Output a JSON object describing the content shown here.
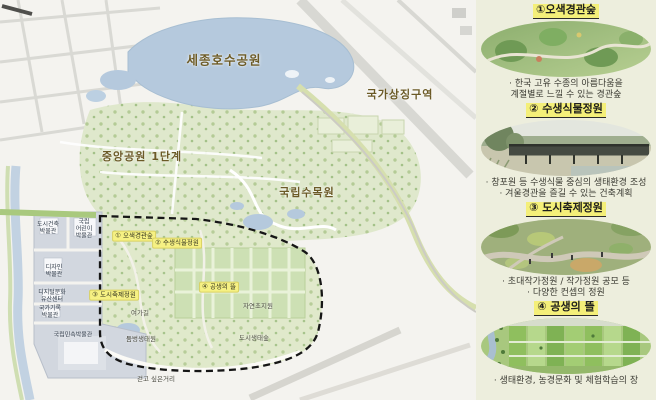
{
  "map": {
    "region_labels": {
      "lake_park": "세종호수공원",
      "national_symbol_zone": "국가상징구역",
      "central_park_phase1": "중앙공원 1단계",
      "national_arboretum": "국립수목원"
    },
    "numbered_labels": {
      "n1": "① 오색경관숲",
      "n2": "② 수생식물정원",
      "n3": "③ 도시축제정원",
      "n4": "④ 공생의 뜰"
    },
    "museum_labels": {
      "urban_architecture": "도시건축\n박물관",
      "children": "국립\n어린이\n박물관",
      "design": "디자인\n박물관",
      "digital_heritage": "디지털문화\n유산센터",
      "archives": "국가기록\n박물관",
      "folk": "국립민속박물관"
    },
    "feature_labels": {
      "leisure_trail": "여가길",
      "pond_eco_garden": "둠벙생태원",
      "natural_grassland": "자연초지원",
      "urban_eco_forest": "도시생태숲",
      "walking_street": "걷고 싶은거리"
    }
  },
  "sidebar": {
    "items": [
      {
        "title": "①오색경관숲",
        "captions": [
          "· 한국 고유 수종의 아름다움을",
          "계절별로 느낄 수 있는 경관숲"
        ]
      },
      {
        "title": "② 수생식물정원",
        "captions": [
          "· 창포원 등 수생식물 중심의 생태환경 조성",
          "· 겨울경관을 즐길 수 있는 건축계획"
        ]
      },
      {
        "title": "③ 도시축제정원",
        "captions": [
          "· 초대작가정원 / 작가정원 공모 등",
          "· 다양한 컨셉의 정원"
        ]
      },
      {
        "title": "④ 공생의 뜰",
        "captions": [
          "· 생태환경, 농경문화 및 체험학습의 장"
        ]
      }
    ]
  },
  "colors": {
    "highlight_yellow": "#f6f183",
    "label_brown": "#6b5a26",
    "sidebar_bg": "#edeedd",
    "lake_blue": "#b5c9dd",
    "park_green": "#dfe8cc",
    "museum_gray": "#d2d7df"
  }
}
